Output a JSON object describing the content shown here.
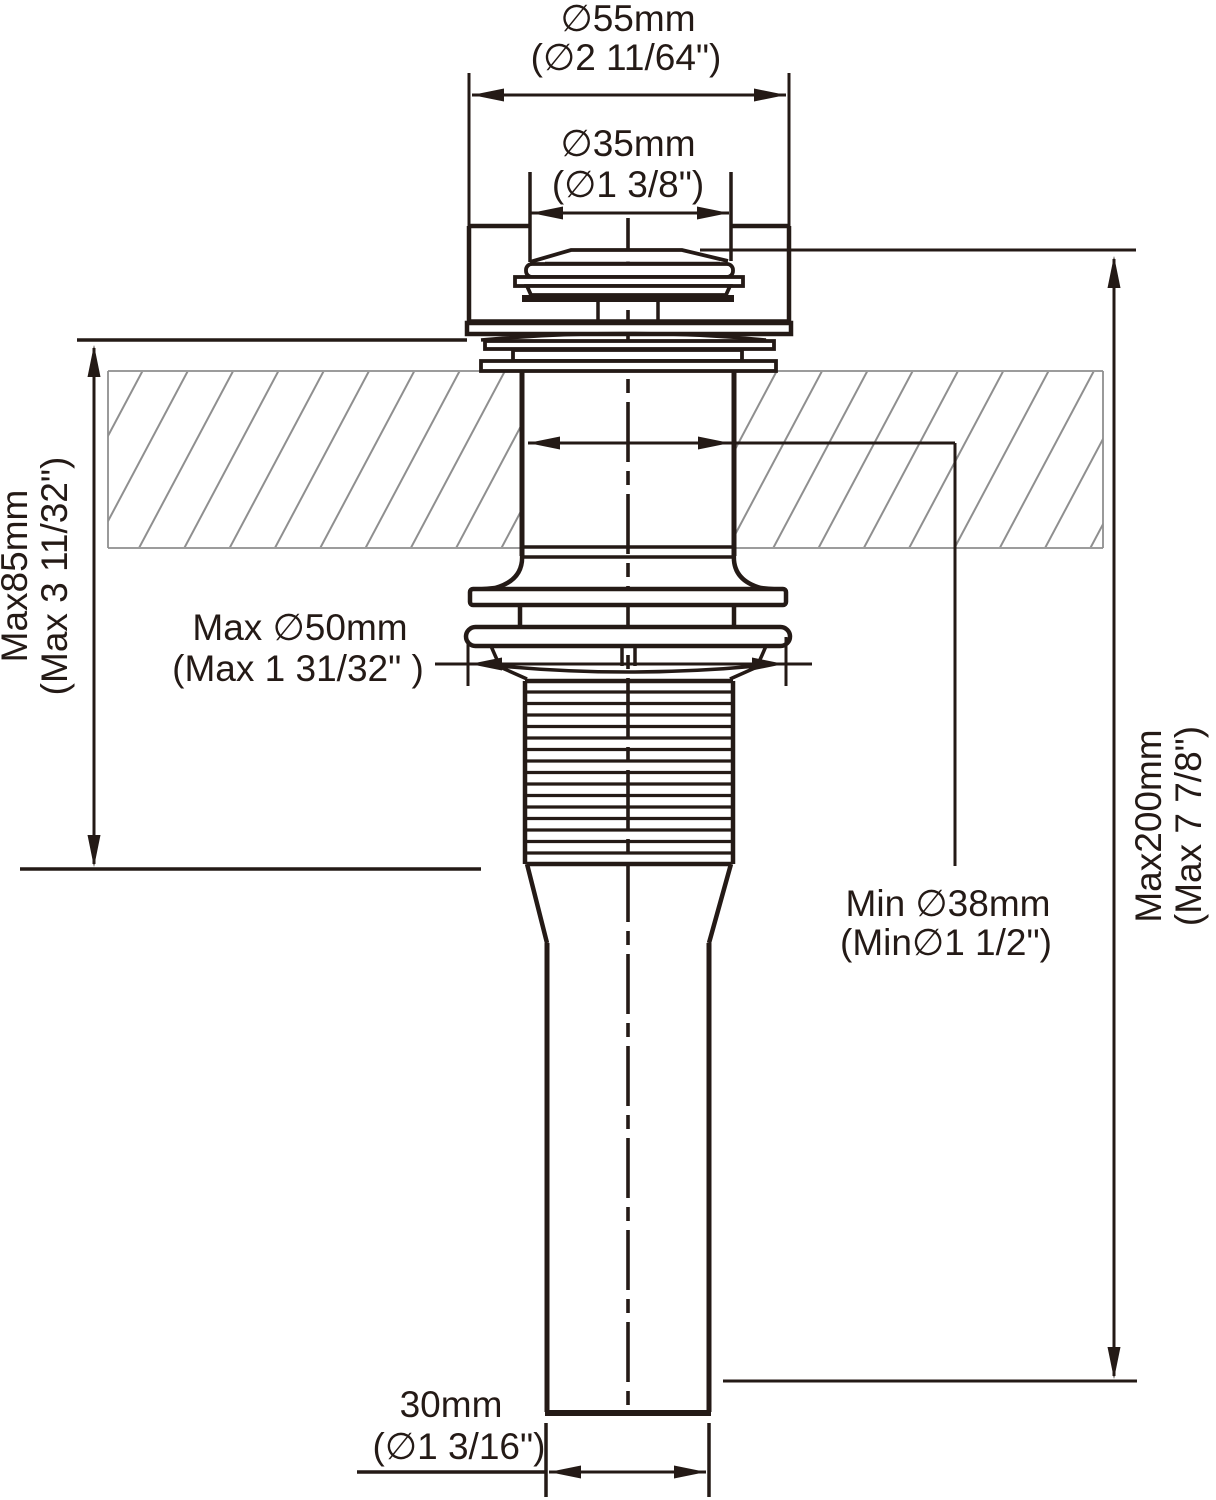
{
  "diagram": {
    "kind": "technical-dimension-drawing",
    "subject": "pop-up sink drain, side section view with countertop"
  },
  "labels": {
    "cap_outer": {
      "metric": "∅55mm",
      "imperial": "(∅2 11/64\")"
    },
    "cap_top": {
      "metric": "∅35mm",
      "imperial": "(∅1 3/8\")"
    },
    "deck_max": {
      "metric": "Max85mm",
      "imperial": "(Max 3 11/32\")"
    },
    "hole_max": {
      "metric": "Max ∅50mm",
      "imperial": "(Max 1 31/32\" )"
    },
    "drain_min": {
      "metric": "Min ∅38mm",
      "imperial": "(Min∅1 1/2\")"
    },
    "height_max": {
      "metric": "Max200mm",
      "imperial": "(Max 7 7/8\")"
    },
    "tail_od": {
      "metric": "30mm",
      "imperial": "(∅1 3/16\")"
    }
  },
  "colors": {
    "ink": "#241a16",
    "counter_line": "#8f8f8f",
    "background": "#ffffff"
  }
}
